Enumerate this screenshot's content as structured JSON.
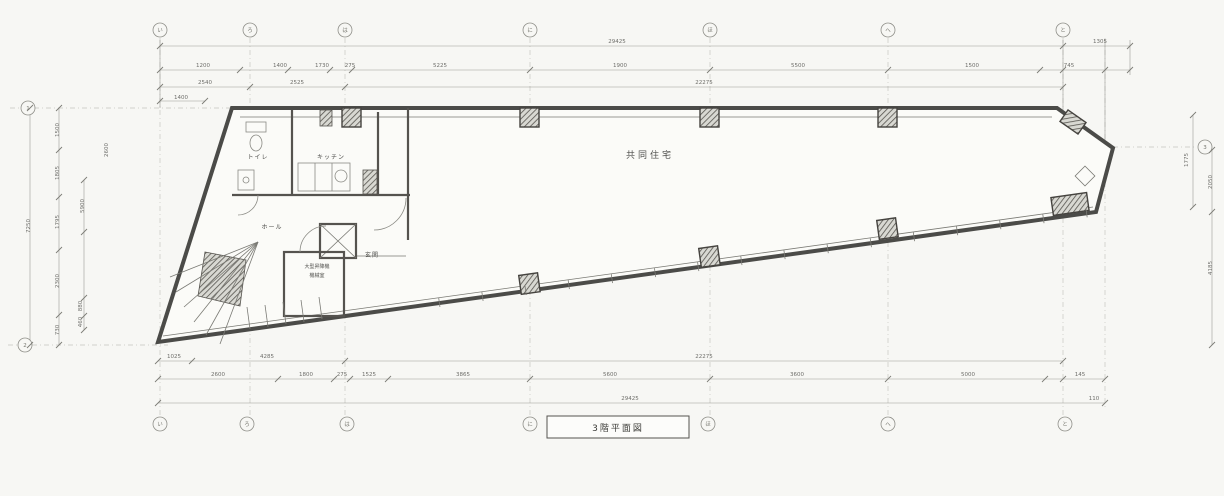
{
  "title": {
    "label": "3階平面図"
  },
  "rooms": [
    {
      "id": "toilet",
      "label": "トイレ",
      "x": 258,
      "y": 159,
      "cls": "room"
    },
    {
      "id": "kitchen",
      "label": "キッチン",
      "x": 331,
      "y": 159,
      "cls": "room"
    },
    {
      "id": "hall",
      "label": "ホール",
      "x": 272,
      "y": 229,
      "cls": "room"
    },
    {
      "id": "entrance",
      "label": "玄関",
      "x": 372,
      "y": 257,
      "cls": "room"
    },
    {
      "id": "residence",
      "label": "共同住宅",
      "x": 650,
      "y": 158,
      "cls": "room-big"
    },
    {
      "id": "elevator-line1",
      "label": "大型昇降機",
      "x": 317,
      "y": 268,
      "cls": "room-sm"
    },
    {
      "id": "elevator-line2",
      "label": "機械室",
      "x": 317,
      "y": 277,
      "cls": "room-sm"
    }
  ],
  "grid": {
    "top": [
      {
        "label": "い",
        "x": 160
      },
      {
        "label": "ろ",
        "x": 250
      },
      {
        "label": "は",
        "x": 345
      },
      {
        "label": "に",
        "x": 530
      },
      {
        "label": "ほ",
        "x": 710
      },
      {
        "label": "へ",
        "x": 888
      },
      {
        "label": "と",
        "x": 1063
      }
    ],
    "bottom": [
      {
        "label": "い",
        "x": 160
      },
      {
        "label": "ろ",
        "x": 247
      },
      {
        "label": "は",
        "x": 347
      },
      {
        "label": "に",
        "x": 530
      },
      {
        "label": "ほ",
        "x": 708
      },
      {
        "label": "へ",
        "x": 888
      },
      {
        "label": "と",
        "x": 1065
      }
    ],
    "left": [
      {
        "label": "1",
        "x": 28,
        "y": 108
      },
      {
        "label": "2",
        "x": 25,
        "y": 345
      }
    ],
    "right": [
      {
        "label": "3",
        "x": 1205,
        "y": 147
      }
    ]
  },
  "dimensions": {
    "top": [
      {
        "v": "29425",
        "x": 617,
        "y": 43
      },
      {
        "v": "1305",
        "x": 1100,
        "y": 43
      },
      {
        "v": "1200",
        "x": 203,
        "y": 67
      },
      {
        "v": "1400",
        "x": 280,
        "y": 67
      },
      {
        "v": "1730",
        "x": 322,
        "y": 67
      },
      {
        "v": "275",
        "x": 350,
        "y": 67
      },
      {
        "v": "5225",
        "x": 440,
        "y": 67
      },
      {
        "v": "1900",
        "x": 620,
        "y": 67
      },
      {
        "v": "5500",
        "x": 798,
        "y": 67
      },
      {
        "v": "1500",
        "x": 972,
        "y": 67
      },
      {
        "v": "745",
        "x": 1069,
        "y": 67
      },
      {
        "v": "2540",
        "x": 205,
        "y": 84
      },
      {
        "v": "2525",
        "x": 297,
        "y": 84
      },
      {
        "v": "22275",
        "x": 704,
        "y": 84
      },
      {
        "v": "1400",
        "x": 181,
        "y": 99
      }
    ],
    "bottom": [
      {
        "v": "1025",
        "x": 174,
        "y": 358
      },
      {
        "v": "4285",
        "x": 267,
        "y": 358
      },
      {
        "v": "22275",
        "x": 704,
        "y": 358
      },
      {
        "v": "2600",
        "x": 218,
        "y": 376
      },
      {
        "v": "1800",
        "x": 306,
        "y": 376
      },
      {
        "v": "275",
        "x": 342,
        "y": 376
      },
      {
        "v": "1525",
        "x": 369,
        "y": 376
      },
      {
        "v": "3865",
        "x": 463,
        "y": 376
      },
      {
        "v": "5600",
        "x": 610,
        "y": 376
      },
      {
        "v": "3600",
        "x": 797,
        "y": 376
      },
      {
        "v": "5000",
        "x": 968,
        "y": 376
      },
      {
        "v": "145",
        "x": 1080,
        "y": 376
      },
      {
        "v": "29425",
        "x": 630,
        "y": 400
      },
      {
        "v": "110",
        "x": 1094,
        "y": 400
      }
    ],
    "left": [
      {
        "v": "7250",
        "x": 30,
        "y": 226,
        "rot": true
      },
      {
        "v": "1500",
        "x": 59,
        "y": 130,
        "rot": true
      },
      {
        "v": "1805",
        "x": 59,
        "y": 173,
        "rot": true
      },
      {
        "v": "1795",
        "x": 59,
        "y": 222,
        "rot": true
      },
      {
        "v": "2300",
        "x": 59,
        "y": 281,
        "rot": true
      },
      {
        "v": "730",
        "x": 59,
        "y": 330,
        "rot": true
      },
      {
        "v": "2600",
        "x": 108,
        "y": 150,
        "rot": true
      },
      {
        "v": "5900",
        "x": 84,
        "y": 206,
        "rot": true
      },
      {
        "v": "880",
        "x": 82,
        "y": 306,
        "rot": true
      },
      {
        "v": "460",
        "x": 82,
        "y": 322,
        "rot": true
      }
    ],
    "right": [
      {
        "v": "1775",
        "x": 1188,
        "y": 160,
        "rot": true
      },
      {
        "v": "2050",
        "x": 1212,
        "y": 182,
        "rot": true
      },
      {
        "v": "4185",
        "x": 1212,
        "y": 268,
        "rot": true
      }
    ]
  },
  "colors": {
    "paper": "#f7f7f4",
    "ink": "#4b4b48",
    "dim": "#8a8a86",
    "hatch": "#55534e"
  }
}
